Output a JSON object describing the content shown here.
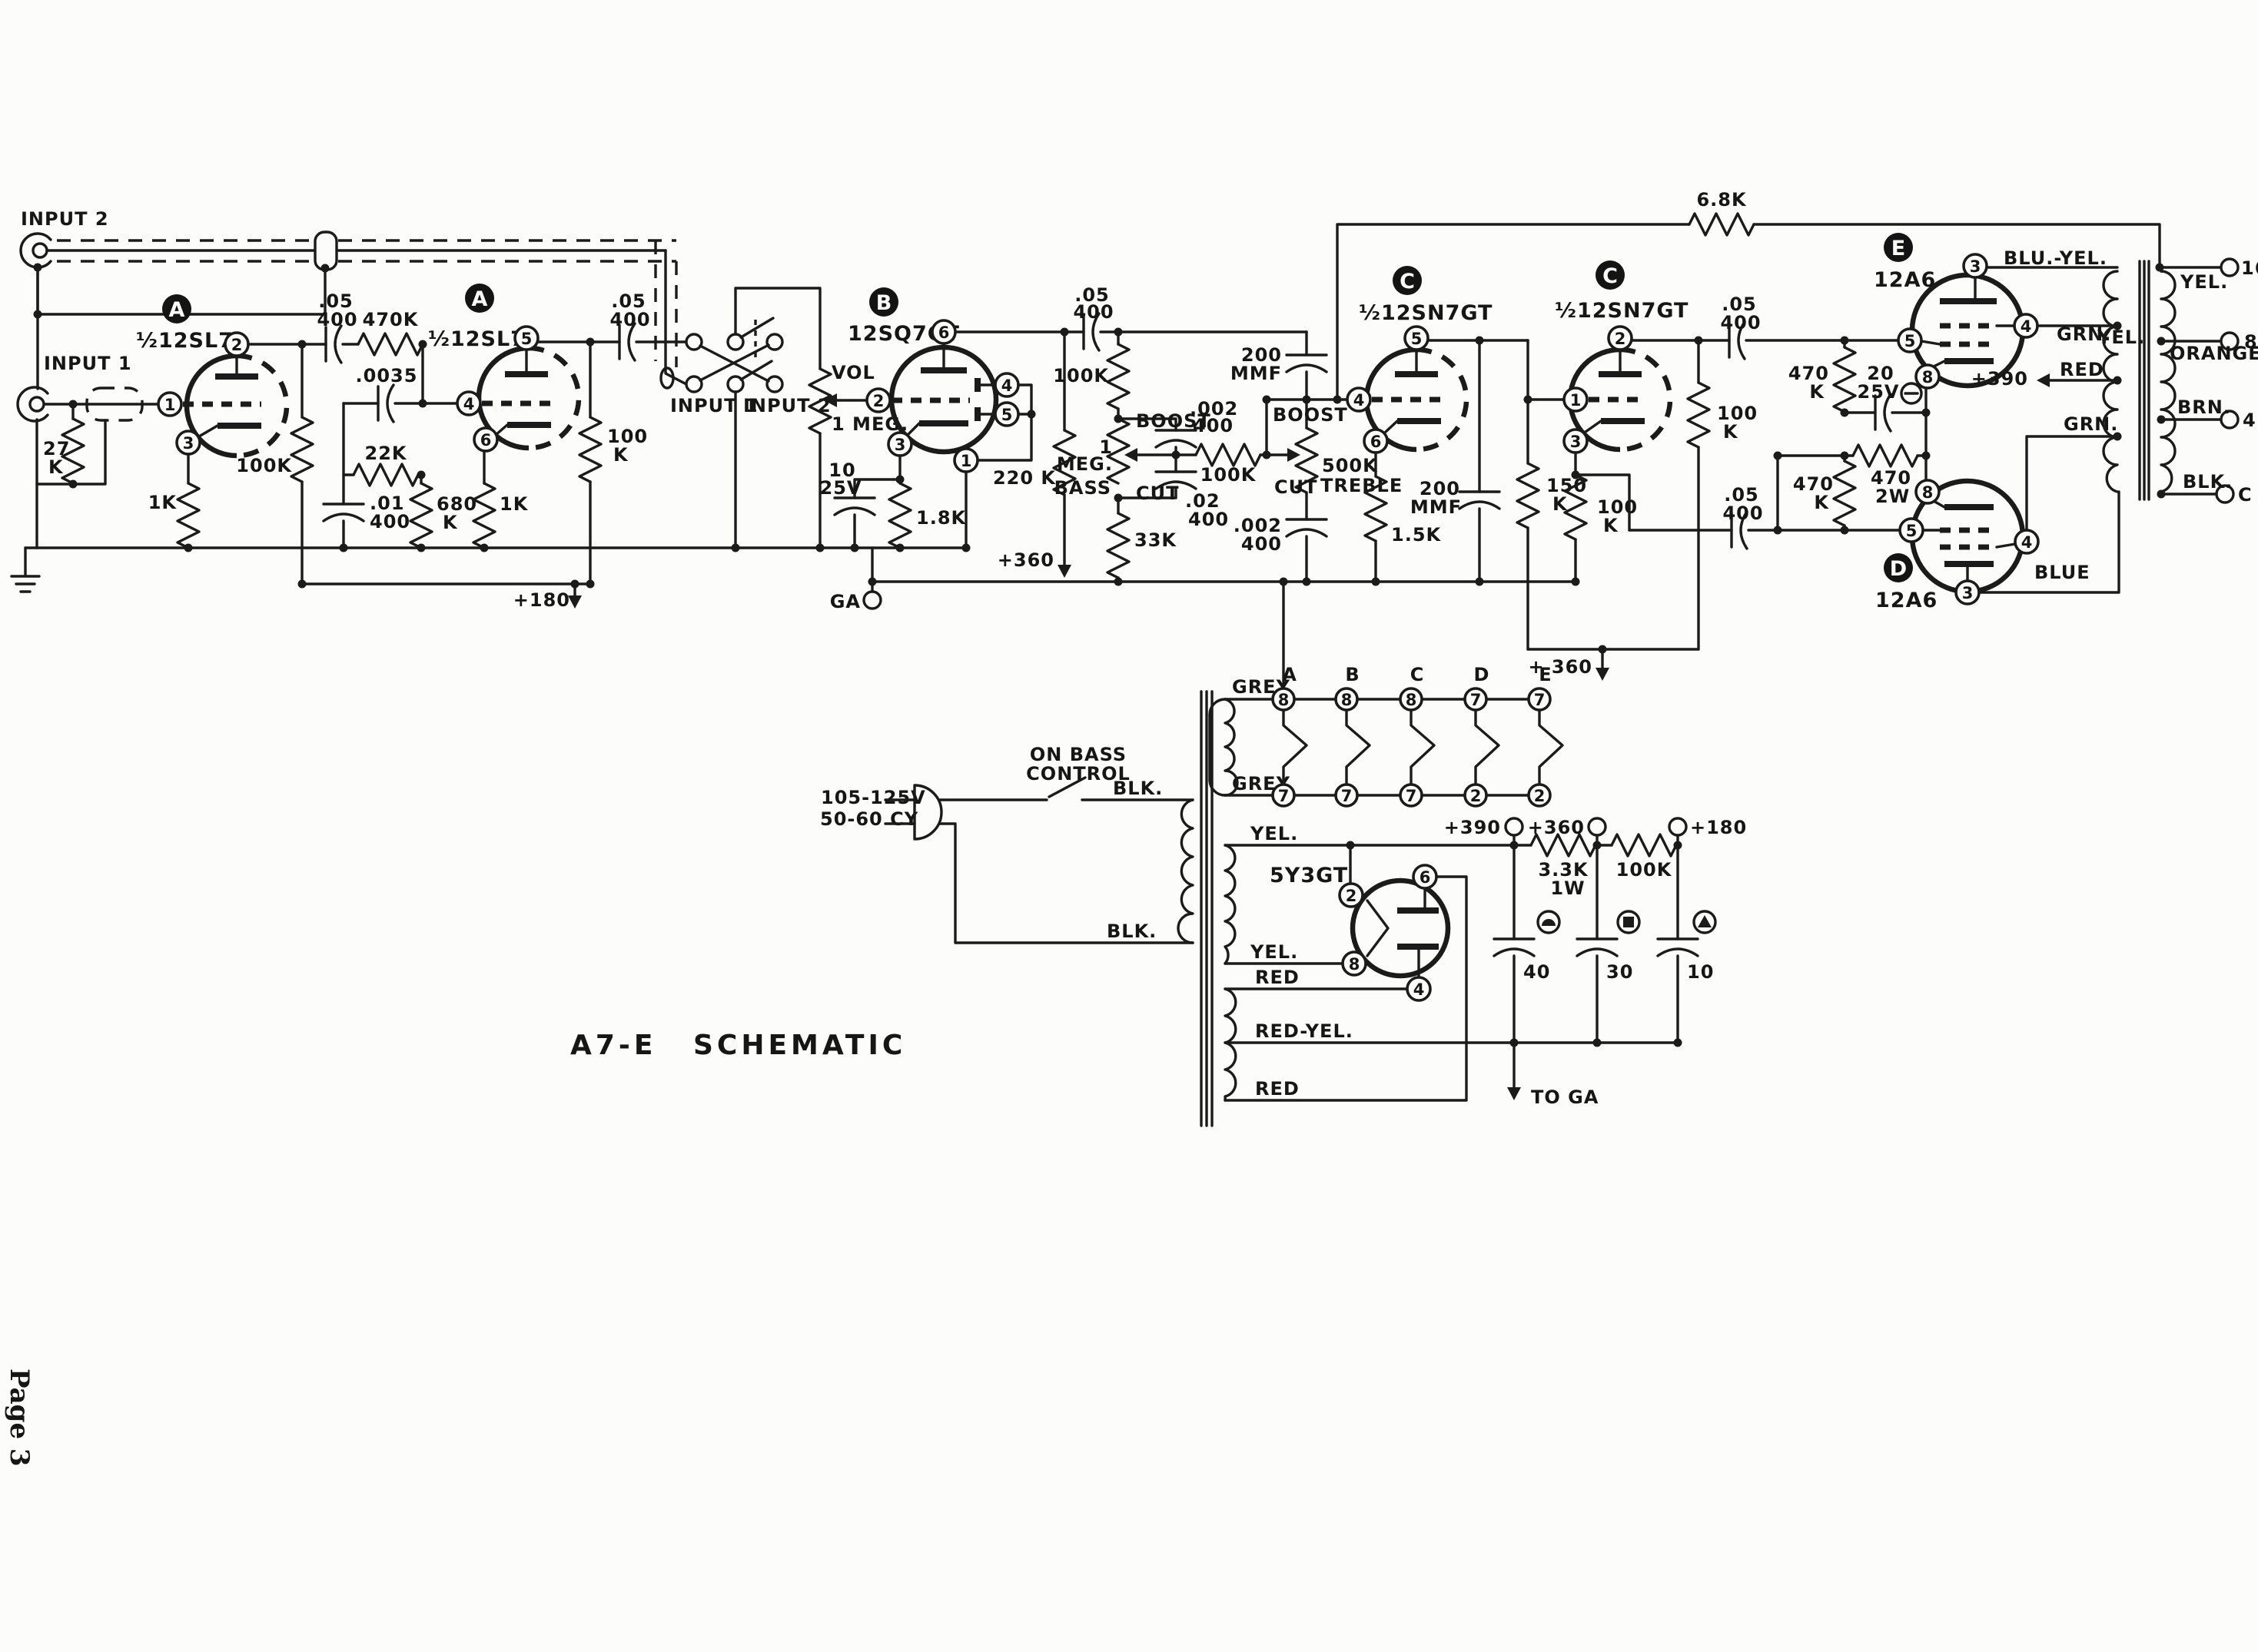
{
  "page": {
    "title": "A7-E SCHEMATIC",
    "page_number": "Page 3"
  },
  "inputs": {
    "input2": "INPUT 2",
    "input1": "INPUT 1",
    "r27k_v": "27",
    "r27k_u": "K"
  },
  "stage_a1": {
    "badge": "A",
    "tube": "½12SL7",
    "pins": [
      "2",
      "1",
      "3"
    ],
    "r_cath": "1K",
    "r_plate": "100K"
  },
  "coupling": {
    "c1_v": ".05",
    "c1_wv": "400",
    "r470k": "470K",
    "c0035": ".0035",
    "r22k": "22K",
    "c01_v": ".01",
    "c01_wv": "400",
    "r680_v": "680",
    "r680_u": "K"
  },
  "stage_a2": {
    "badge": "A",
    "tube": "½12SL7",
    "pins": [
      "5",
      "4",
      "6"
    ],
    "r_cath": "1K",
    "r_plate_v": "100",
    "r_plate_u": "K",
    "c_out_v": ".05",
    "c_out_wv": "400",
    "b_plus": "+180"
  },
  "switch": {
    "input1": "INPUT 1",
    "input2": "INPUT 2"
  },
  "vol": {
    "name": "VOL",
    "value": "1 MEG."
  },
  "stage_b": {
    "badge": "B",
    "tube": "12SQ7GT",
    "pins": [
      "6",
      "2",
      "4",
      "5",
      "3",
      "1"
    ],
    "c_cath_v": "10",
    "c_cath_wv": "25V",
    "r_cath": "1.8K",
    "r_plate": "220 K",
    "b_plus": "+360",
    "ga": "GA",
    "c_out_v": ".05",
    "c_out_wv": "400"
  },
  "tone": {
    "r_in": "100K",
    "bass_1": "1",
    "bass_2": "MEG.",
    "bass_3": "BASS",
    "boost": "BOOST",
    "cut": "CUT",
    "c_boost_v": ".002",
    "c_boost_wv": "400",
    "c_cut_v": ".02",
    "c_cut_wv": "400",
    "r_mid": "100K",
    "r_33k": "33K",
    "c_treb_v": "200",
    "c_treb_u": "MMF",
    "treb_boost": "BOOST",
    "treb_cut": "CUT",
    "r_treb": "500K",
    "treb_name": "TREBLE",
    "c_tcut_v": ".002",
    "c_tcut_wv": "400"
  },
  "stage_c1": {
    "badge": "C",
    "tube": "½12SN7GT",
    "pins": [
      "5",
      "4",
      "6"
    ],
    "r_cath": "1.5K",
    "c_plate_v": "200",
    "c_plate_u": "MMF",
    "r_plate_v": "150",
    "r_plate_u": "K"
  },
  "stage_c2": {
    "badge": "C",
    "tube": "½12SN7GT",
    "pins": [
      "2",
      "1",
      "3"
    ],
    "r_cath_v": "100",
    "r_cath_u": "K",
    "r_plate_v": "100",
    "r_plate_u": "K",
    "b_plus": "+ 360",
    "c_out_v": ".05",
    "c_out_wv": "400"
  },
  "output": {
    "r_fb": "6.8K",
    "r_grid1_v": "470",
    "r_grid1_u": "K",
    "c_bias_v": "20",
    "c_bias_wv": "25V",
    "r_470_v": "470",
    "r_470_u": "2W",
    "r_grid2_v": "470",
    "r_grid2_u": "K",
    "c_low_v": ".05",
    "c_low_wv": "400",
    "tube_e": {
      "badge": "E",
      "name": "12A6",
      "pins": [
        "3",
        "4",
        "5",
        "8"
      ]
    },
    "tube_d": {
      "badge": "D",
      "name": "12A6",
      "pins": [
        "8",
        "5",
        "4",
        "3"
      ]
    },
    "wires": {
      "blu_yel": "BLU.-YEL.",
      "grn1": "GRN.",
      "yel1": "YEL.",
      "red": "RED",
      "plus390": "+390",
      "grn2": "GRN.",
      "blue": "BLUE"
    }
  },
  "ot": {
    "taps": [
      {
        "wire": "YEL.",
        "term": "16"
      },
      {
        "wire": "ORANGE",
        "term": "8"
      },
      {
        "wire": "BRN.",
        "term": "4"
      },
      {
        "wire": "BLK.",
        "term": "C"
      }
    ]
  },
  "heaters": {
    "grey_top": "GREY",
    "grey_bot": "GREY",
    "tubes": [
      "A",
      "B",
      "C",
      "D",
      "E"
    ],
    "pins_top": [
      "8",
      "8",
      "8",
      "7",
      "7"
    ],
    "pins_bot": [
      "7",
      "7",
      "7",
      "2",
      "2"
    ]
  },
  "power": {
    "mains_v": "105-125V",
    "mains_f": "50-60 CY",
    "switch_1": "ON BASS",
    "switch_2": "CONTROL",
    "blk_top": "BLK.",
    "blk_bot": "BLK.",
    "rect": "5Y3GT",
    "rect_pins": [
      "2",
      "8",
      "6",
      "4"
    ],
    "yel_top": "YEL.",
    "yel_bot": "YEL.",
    "red_top": "RED",
    "red_yel": "RED-YEL.",
    "red_bot": "RED",
    "rail": {
      "v390": "+390",
      "r1_v": "3.3K",
      "r1_w": "1W",
      "v360": "+360",
      "r2": "100K",
      "v180": "+180",
      "c40": "40",
      "c30": "30",
      "c10": "10",
      "to_ga": "TO GA"
    }
  }
}
